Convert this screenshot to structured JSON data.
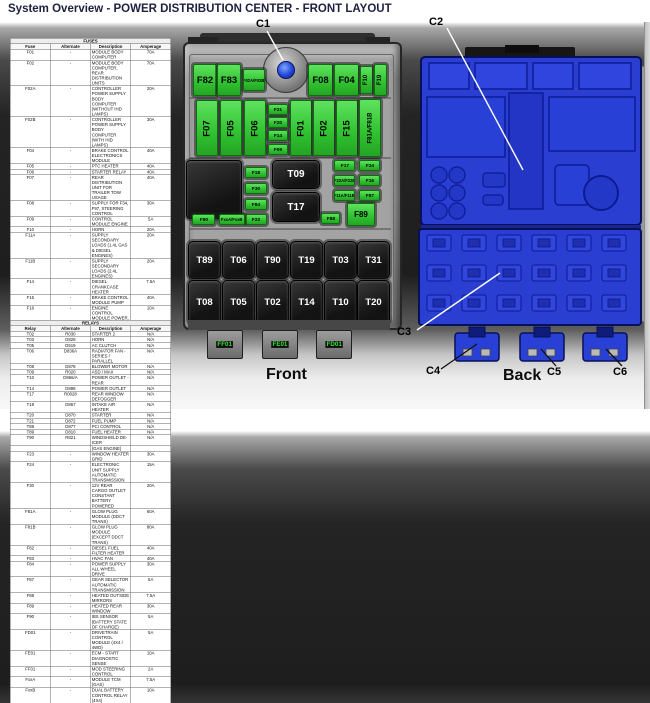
{
  "title": "System Overview - POWER DISTRIBUTION CENTER - FRONT LAYOUT",
  "colors": {
    "fuse_green": "#3fd23f",
    "relay_black": "#161616",
    "back_blue": "#2b3ed2",
    "housing_gray": "#999999",
    "title_text": "#1f2040"
  },
  "fuse_table": {
    "title": "FUSES",
    "headers": [
      "Fuse",
      "Alternate",
      "Description",
      "Amperage"
    ],
    "rows": [
      [
        "F01",
        "-",
        "MODULE BODY COMPUTER",
        "70A"
      ],
      [
        "F02",
        "-",
        "MODULE BODY COMPUTER, REAR DISTRIBUTION UNITS",
        "70A"
      ],
      [
        "F02A",
        "-",
        "CONTROLLER POWER SUPPLY BODY COMPUTER (WITHOUT HID LAMPS)",
        "20A"
      ],
      [
        "F02B",
        "-",
        "CONTROLLER POWER SUPPLY BODY COMPUTER (WITH HID LAMPS)",
        "30A"
      ],
      [
        "F04",
        "-",
        "BRAKE CONTROL ELECTRONICS MODULE",
        "40A"
      ],
      [
        "F05",
        "-",
        "PTC HEATER",
        "40A"
      ],
      [
        "F06",
        "-",
        "STARTER RELAY",
        "40A"
      ],
      [
        "F07",
        "-",
        "REAR DISTRIBUTION UNIT FOR TRAILER TOW USAGE",
        "40A"
      ],
      [
        "F08",
        "-",
        "SUPPLY FOR F34, F97, STEERING CONTROL",
        "30A"
      ],
      [
        "F09",
        "-",
        "CONTROL MODULE ENGINE",
        "5A"
      ],
      [
        "F10",
        "-",
        "HORN",
        "20A"
      ],
      [
        "F11A",
        "-",
        "SUPPLY SECONDARY LOADS (1.4L GAS & DIESEL ENGINES)",
        "20A"
      ],
      [
        "F11B",
        "-",
        "SUPPLY SECONDARY LOADS (2.4L ENGINES)",
        "20A"
      ],
      [
        "F14",
        "-",
        "DIESEL CRANKCASE HEATER",
        "7.5A"
      ],
      [
        "F15",
        "-",
        "BRAKE CONTROL MODULE PUMP",
        "40A"
      ],
      [
        "F16",
        "-",
        "ENGINE CONTROL MODULE POWER, AUTOMATIC TRANSMISSION",
        "10A"
      ],
      [
        "F17",
        "-",
        "ENGINE SECONDARY LOADS (EXCEPT 2.4L)",
        "10A"
      ],
      [
        "F18",
        "-",
        "12V REAR CARGO OUTLET IGNITION POWERED",
        "20A"
      ],
      [
        "F19",
        "-",
        "AIR CONDITIONER COMPRESSOR AND PWM RAD FAN ENABLE",
        "7.5A"
      ],
      [
        "F20",
        "-",
        "CIGAR LIGHTER",
        "20A"
      ],
      [
        "F21",
        "-",
        "FUEL PUMP",
        "15A"
      ],
      [
        "F22A",
        "-",
        "POWER CONTROL MODULE ENGINE (DIESEL ENGINE)",
        "15A"
      ],
      [
        "F22B",
        "-",
        "POWER CONTROL MODULE ENGINE (GAS ENGINE)",
        "20A"
      ],
      [
        "F23",
        "-",
        "WINDOW HEATER GRID",
        "30A"
      ],
      [
        "F24",
        "-",
        "ELECTRONIC UNIT SUPPLY AUTOMATIC TRANSMISSION",
        "15A"
      ],
      [
        "F30",
        "-",
        "12V REAR CARGO OUTLET CONSTANT BATTERY POWERED",
        "20A"
      ],
      [
        "F81A",
        "-",
        "GLOW PLUG MODULE (DDCT TRANS)",
        "60A"
      ],
      [
        "F81B",
        "-",
        "GLOW PLUG MODULE (EXCEPT DDCT TRANS)",
        "80A"
      ],
      [
        "F82",
        "-",
        "DIESEL FUEL FILTER HEATER",
        "40A"
      ],
      [
        "F83",
        "-",
        "HVAC FAN",
        "40A"
      ],
      [
        "F84",
        "-",
        "POWER SUPPLY ALL WHEEL DRIVE",
        "30A"
      ],
      [
        "F87",
        "-",
        "GEAR SELECTOR AUTOMATIC TRANSMISSION",
        "5A"
      ],
      [
        "F88",
        "-",
        "HEATED OUTSIDE MIRRORS",
        "7.5A"
      ],
      [
        "F89",
        "-",
        "HEATED REAR WINDOW",
        "30A"
      ],
      [
        "F90",
        "-",
        "IBS SENSOR (BATTERY STATE OF CHARGE)",
        "5A"
      ],
      [
        "FD01",
        "-",
        "DRIVETRAIN CONTROL MODULE (4X4 / 4WD)",
        "5A"
      ],
      [
        "FE01",
        "-",
        "ECM - START DIAGNOSTIC SENSE",
        "10A"
      ],
      [
        "FF01",
        "-",
        "MOD STEERING CONTROL",
        "2A"
      ],
      [
        "FxxA",
        "-",
        "MODULE TCM (GAS)",
        "7.5A"
      ],
      [
        "FxxB",
        "-",
        "DUAL BATTERY CONTROL RELAY (4X4)",
        "10A"
      ]
    ]
  },
  "relay_table": {
    "title": "RELAYS",
    "headers": [
      "Relay",
      "Alternate",
      "Description",
      "Amperage"
    ],
    "rows": [
      [
        "T02",
        "R030",
        "STARTER 2",
        "N/A"
      ],
      [
        "T03",
        "D828",
        "HORN",
        "N/A"
      ],
      [
        "T05",
        "D519",
        "AC CLUTCH",
        "N/A"
      ],
      [
        "T06",
        "D836A",
        "RADIATOR FAN - SERIES / PARALLEL",
        "N/A"
      ],
      [
        "T08",
        "D878",
        "BLOWER MOTOR",
        "N/A"
      ],
      [
        "T09",
        "R020",
        "ASD / MAX",
        "N/A"
      ],
      [
        "T10",
        "D866/A",
        "POWER OUTLET - REAR",
        "N/A"
      ],
      [
        "T14",
        "D898",
        "POWER OUTLET",
        "N/A"
      ],
      [
        "T17",
        "R0028",
        "REAR WINDOW DEFOGGER",
        "N/A"
      ],
      [
        "T19",
        "D867",
        "INTAKE AIR HEATER",
        "N/A"
      ],
      [
        "T20",
        "D870",
        "STARTER",
        "N/A"
      ],
      [
        "T21",
        "D872",
        "FUEL PUMP",
        "N/A"
      ],
      [
        "T88",
        "D877",
        "PCI CONTROL",
        "N/A"
      ],
      [
        "T89",
        "D810",
        "FUEL HEATER",
        "N/A"
      ],
      [
        "T90",
        "R821",
        "WINDSHIELD DE-ICER",
        "N/A"
      ]
    ]
  },
  "front": {
    "caption": "Front",
    "f82": "F82",
    "f83": "F83",
    "f02ab": "F02A/F02B",
    "f08": "F08",
    "f04": "F04",
    "f10": "F10",
    "f19": "F19",
    "f07": "F07",
    "f05": "F05",
    "f06": "F06",
    "f21": "F21",
    "f20": "F20",
    "f14": "F14",
    "f09": "F09",
    "f01": "F01",
    "f02": "F02",
    "f15": "F15",
    "f81ab": "F81A/F81B",
    "f18": "F18",
    "f30": "F30",
    "f84": "F84",
    "f23": "F23",
    "t09": "T09",
    "t17": "T17",
    "f17": "F17",
    "f24": "F24",
    "f22ab": "F22A/F22B",
    "f16": "F16",
    "f11ab": "F11A/F11B",
    "f87": "F87",
    "f88": "F88",
    "f89": "F89",
    "f90": "F90",
    "fxxab": "FxxA/FxxB",
    "t89": "T89",
    "t06": "T06",
    "t90": "T90",
    "t19": "T19",
    "t03": "T03",
    "t31": "T31",
    "t08": "T08",
    "t05": "T05",
    "t02": "T02",
    "t14": "T14",
    "t10": "T10",
    "t20": "T20",
    "ff01": "FF01",
    "fe01": "FE01",
    "fd01": "FD01"
  },
  "back": {
    "caption": "Back"
  },
  "callouts": {
    "c1": "C1",
    "c2": "C2",
    "c3": "C3",
    "c4": "C4",
    "c5": "C5",
    "c6": "C6"
  }
}
